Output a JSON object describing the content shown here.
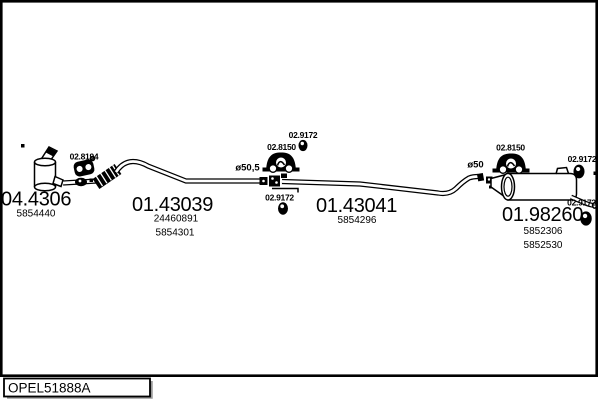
{
  "colors": {
    "ink": "#000000",
    "paper": "#ffffff",
    "shadow": "#9a9a9a"
  },
  "footer": {
    "code": "OPEL51888A"
  },
  "parts": {
    "catalyst": {
      "code": "04.4306",
      "oem1": "5854440"
    },
    "front_pipe": {
      "code": "01.43039",
      "oem1": "24460891",
      "oem2": "5854301"
    },
    "center_pipe": {
      "code": "01.43041",
      "oem1": "5854296"
    },
    "rear_muffler": {
      "code": "01.98260",
      "oem1": "5852306",
      "oem2": "5852530"
    }
  },
  "fittings": {
    "front_hanger": {
      "code": "02.8194"
    },
    "mid_hanger": {
      "code": "02.8150"
    },
    "rear_hanger": {
      "code": "02.8150"
    },
    "mid_ring_top": {
      "code": "02.9172"
    },
    "mid_ring_bottom": {
      "code": "02.9172"
    },
    "rear_ring_top": {
      "code": "02.9172"
    },
    "rear_ring_bottom": {
      "code": "02.9172"
    }
  },
  "dimensions": {
    "front_to_center": "ø50,5",
    "center_to_rear": "ø50"
  }
}
